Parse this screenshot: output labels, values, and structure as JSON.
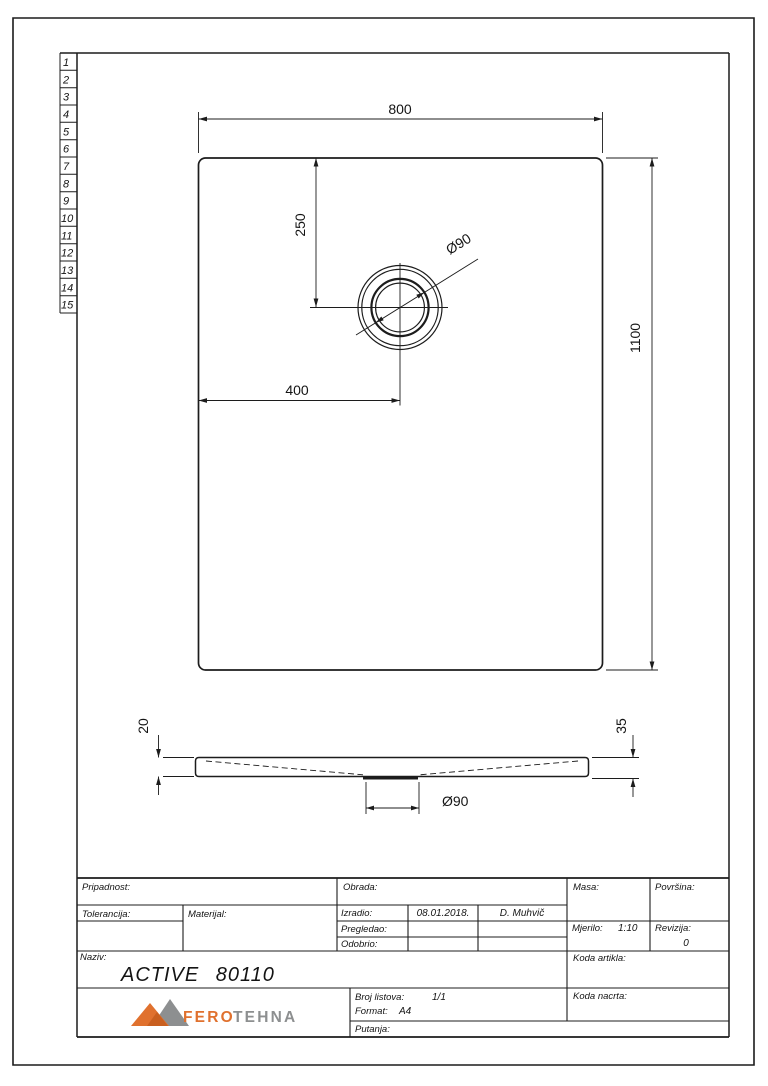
{
  "sheet": {
    "row_numbers": [
      "1",
      "2",
      "3",
      "4",
      "5",
      "6",
      "7",
      "8",
      "9",
      "10",
      "11",
      "12",
      "13",
      "14",
      "15"
    ]
  },
  "top_view": {
    "dim_width": "800",
    "dim_height": "1100",
    "dim_drain_offset_y": "250",
    "dim_drain_offset_x": "400",
    "dim_drain_diameter": "Ø90"
  },
  "section_view": {
    "dim_edge_thickness": "20",
    "dim_total_height": "35",
    "dim_drain_diameter": "Ø90"
  },
  "title_block": {
    "pripadnost_label": "Pripadnost:",
    "obrada_label": "Obrada:",
    "masa_label": "Masa:",
    "povrsina_label": "Površina:",
    "tolerancija_label": "Tolerancija:",
    "materijal_label": "Materijal:",
    "izradio_label": "Izradio:",
    "izradio_date": "08.01.2018.",
    "izradio_name": "D. Muhvič",
    "pregledao_label": "Pregledao:",
    "odobrio_label": "Odobrio:",
    "mjerilo_label": "Mjerilo:",
    "mjerilo_value": "1:10",
    "revizija_label": "Revizija:",
    "revizija_value": "0",
    "naziv_label": "Naziv:",
    "naziv_value": "ACTIVE 80110",
    "koda_artikla_label": "Koda artikla:",
    "koda_nacrta_label": "Koda nacrta:",
    "broj_listova_label": "Broj listova:",
    "broj_listova_value": "1/1",
    "format_label": "Format:",
    "format_value": "A4",
    "putanja_label": "Putanja:",
    "logo_fero": "FERO",
    "logo_tehna": "TEHNA"
  },
  "colors": {
    "logo_orange": "#e0712e",
    "logo_orange_dark": "#c95f1f",
    "logo_gray": "#8d8f90",
    "line": "#1c1c1c"
  }
}
